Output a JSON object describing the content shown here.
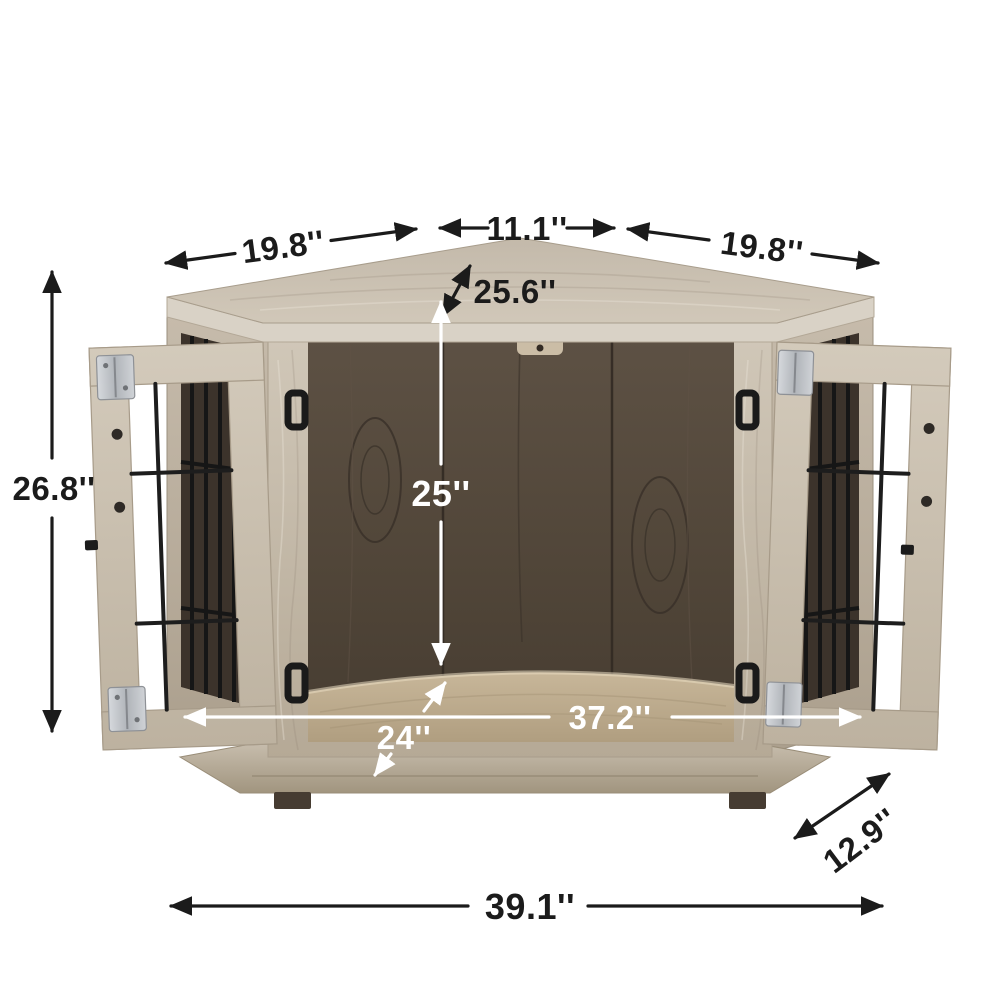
{
  "dims": {
    "top_left": "19.8''",
    "top_center": "11.1''",
    "top_right": "19.8''",
    "top_depth": "25.6''",
    "overall_height": "26.8''",
    "interior_height": "25''",
    "interior_width": "37.2''",
    "opening_depth": "24''",
    "side_depth": "12.9''",
    "overall_width": "39.1''"
  },
  "colors": {
    "background": "#ffffff",
    "dimension_dark": "#1b1b1b",
    "dimension_light": "#ffffff",
    "wood_light": "#d2c9ba",
    "wood_medium": "#b9ad9c",
    "wood_edge_band": "#d9d2c6",
    "interior_dark": "#4e4338",
    "cushion_tan": "#c2b093",
    "wire_black": "#1d1d1d",
    "hinge_silver": "#c3c6ca",
    "feet_dark": "#463c32"
  }
}
